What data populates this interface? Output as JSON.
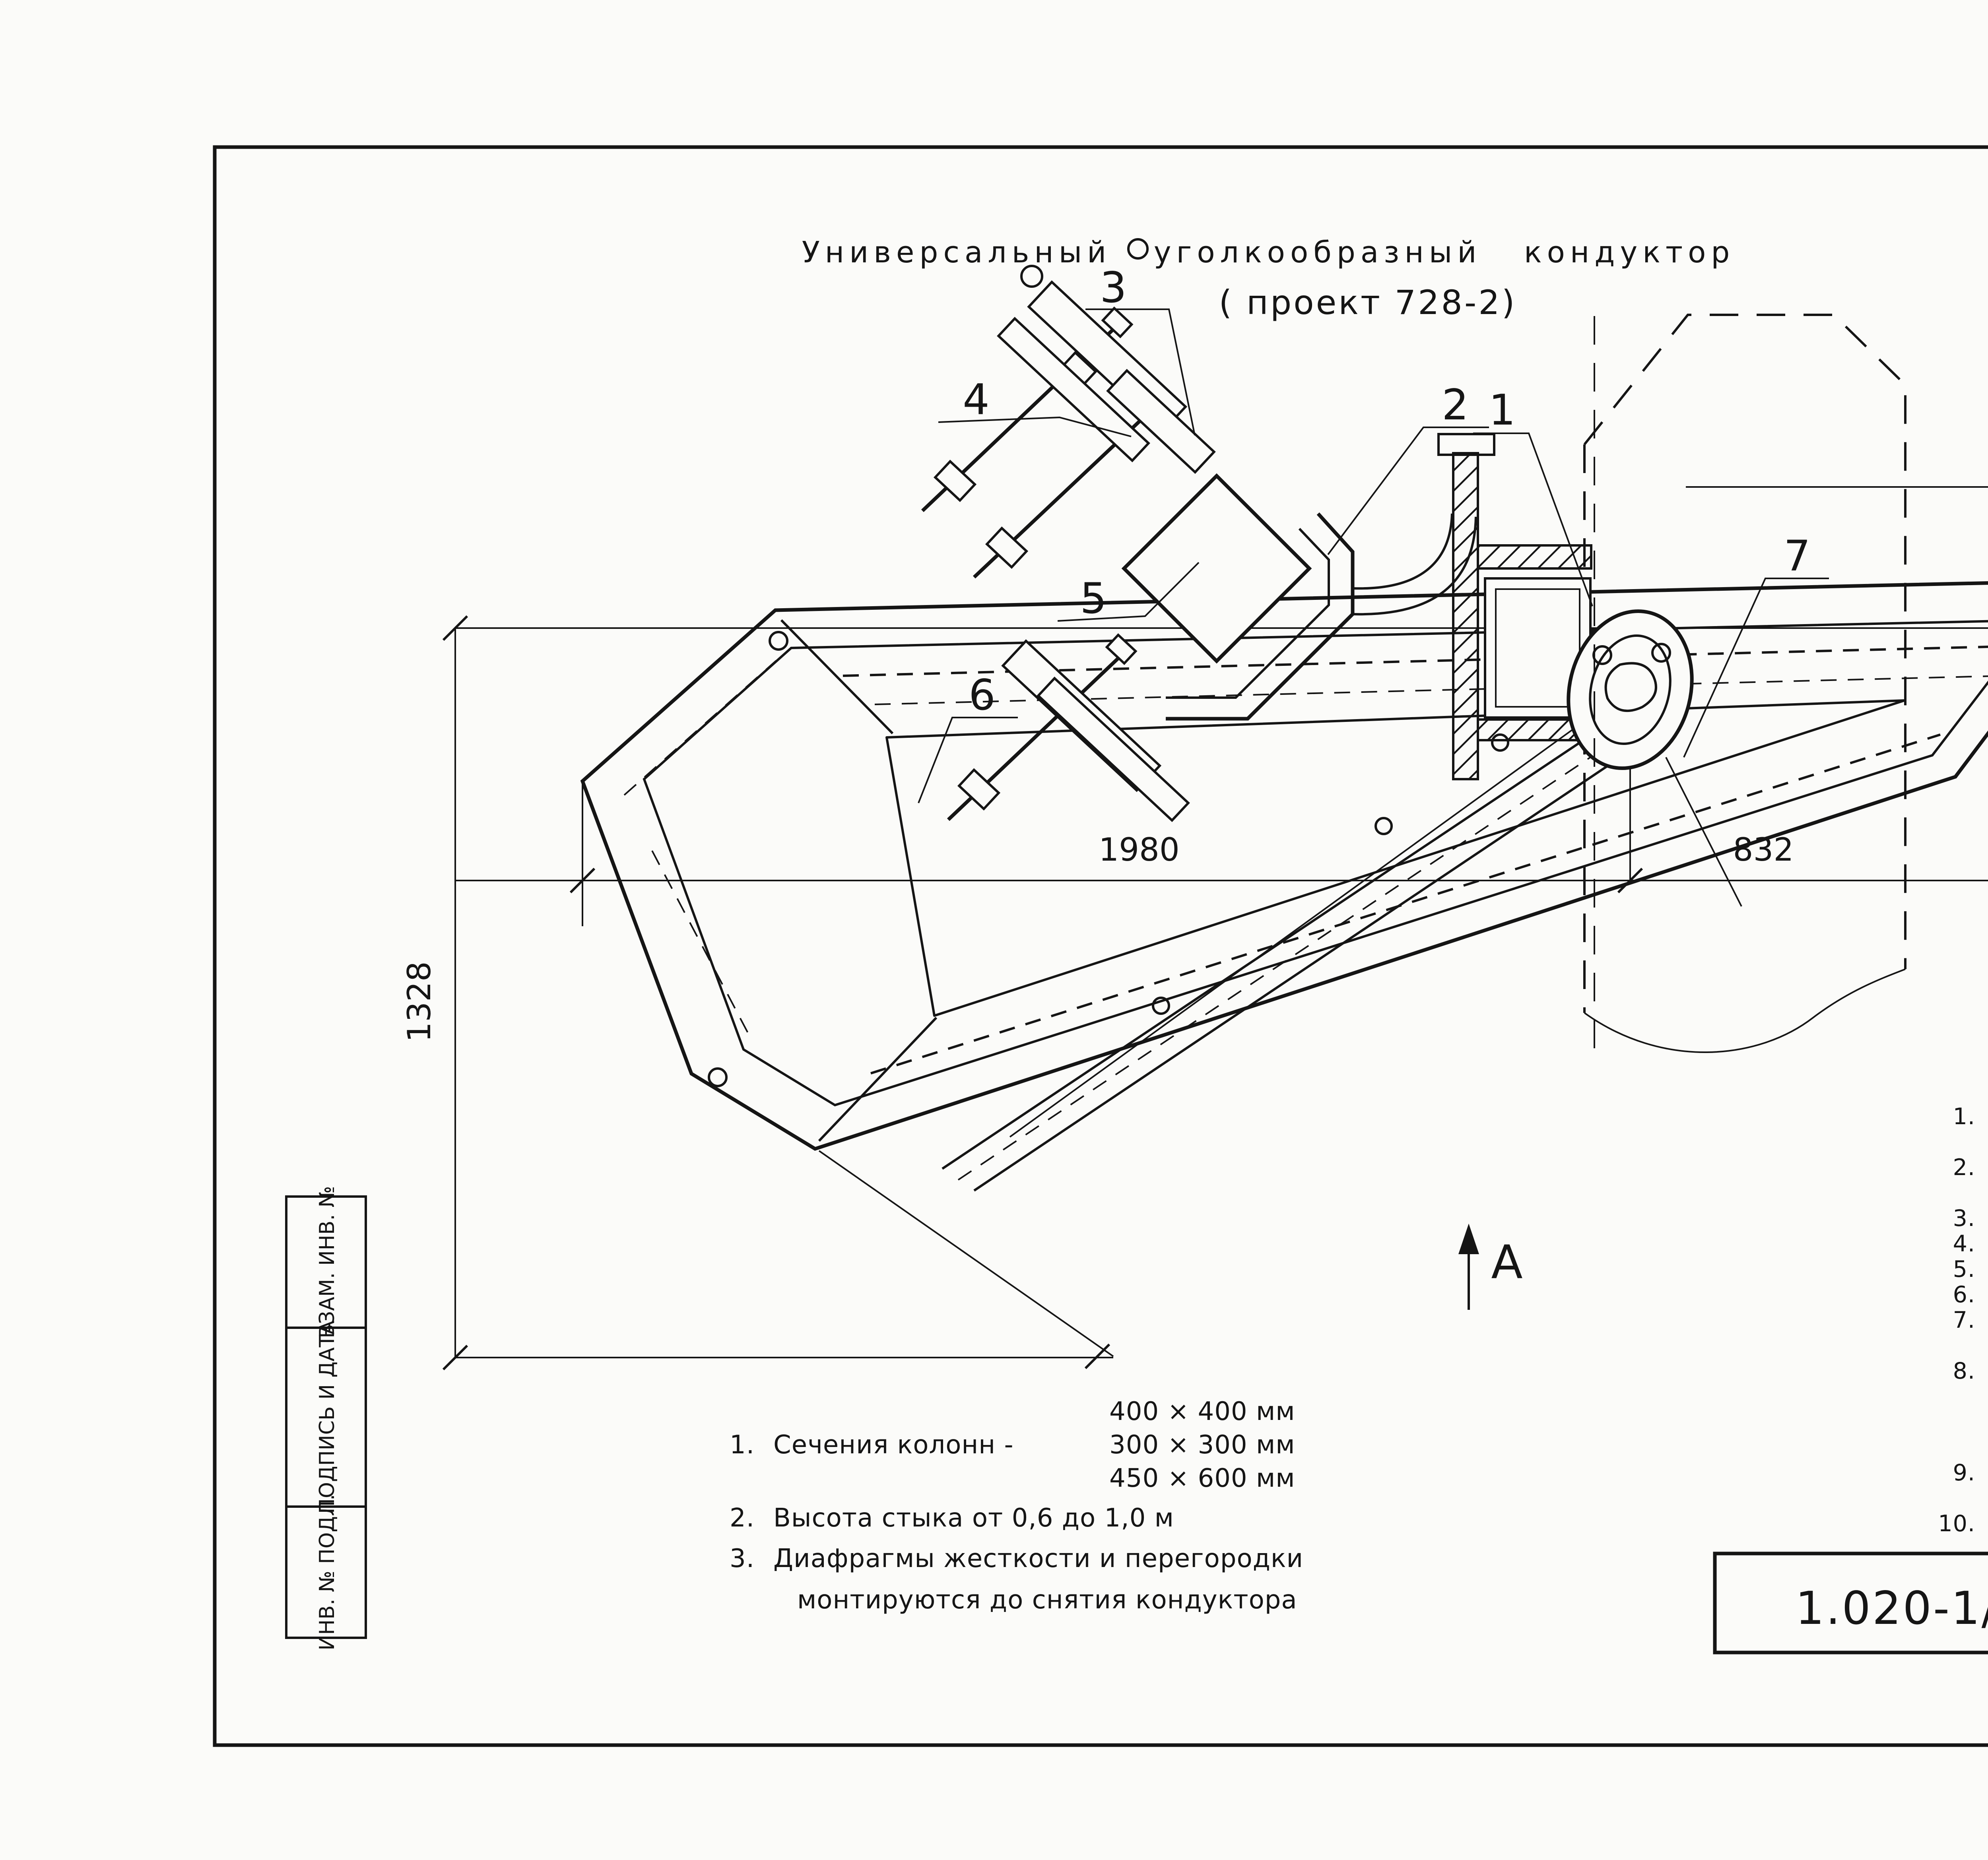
{
  "page": {
    "number": "85"
  },
  "title": {
    "line1": "Универсальный уголкообразный кондуктор",
    "line2": "( проект 728-2)"
  },
  "callouts": {
    "c1": "1",
    "c2": "2",
    "c3": "3",
    "c4": "4",
    "c5": "5",
    "c6": "6",
    "c7": "7"
  },
  "view_marker": {
    "label": "А"
  },
  "dimensions": {
    "d1980": "1980",
    "d832": "832",
    "d1328": "1328",
    "d340": "340"
  },
  "legend": {
    "header": "Экспликация:",
    "items": [
      {
        "num": "1.",
        "lines": [
          "Прямоугольная стойка",
          "кондуктора"
        ]
      },
      {
        "num": "2.",
        "lines": [
          "Приставной уголкообразный",
          "хомут"
        ]
      },
      {
        "num": "3.",
        "lines": [
          "Выдвижной рычаг"
        ]
      },
      {
        "num": "4.",
        "lines": [
          "Регулировочный винт"
        ]
      },
      {
        "num": "5.",
        "lines": [
          "Монтируемая колонна"
        ]
      },
      {
        "num": "6.",
        "lines": [
          "Фасадная площадка"
        ]
      },
      {
        "num": "7.",
        "lines": [
          "Узел крепления фасадной",
          "площадки"
        ]
      },
      {
        "num": "8.",
        "lines": [
          "Выдвижная стойка пло-",
          "щадки для монтажа",
          "ригелей и межколон-",
          "ных плит"
        ]
      },
      {
        "num": "9.",
        "lines": [
          "Площадка для монтажа",
          "ригелей и межколонных плит"
        ]
      },
      {
        "num": "10.",
        "lines": [
          "Лестница"
        ]
      }
    ]
  },
  "notes": {
    "item1": {
      "num": "1.",
      "label": "Сечения колонн -",
      "sizes": [
        "400 × 400 мм",
        "300 × 300 мм",
        "450 × 600 мм"
      ]
    },
    "item2": {
      "num": "2.",
      "text": "Высота стыка от 0,6 до 1,0 м"
    },
    "item3": {
      "num": "3.",
      "line1": "Диафрагмы жесткости и перегородки",
      "line2": "монтируются до снятия кондуктора"
    }
  },
  "title_block": {
    "doc_number": "1.020-1/87. 0-8-К8",
    "sheet_label": "ЛИСТ",
    "sheet_number": "3"
  },
  "sidebar": {
    "cells": [
      {
        "label": "ВЗАМ. ИНВ. №"
      },
      {
        "label": "ПОДПИСЬ И ДАТА"
      },
      {
        "label": "ИНВ. № ПОДЛ."
      }
    ]
  }
}
